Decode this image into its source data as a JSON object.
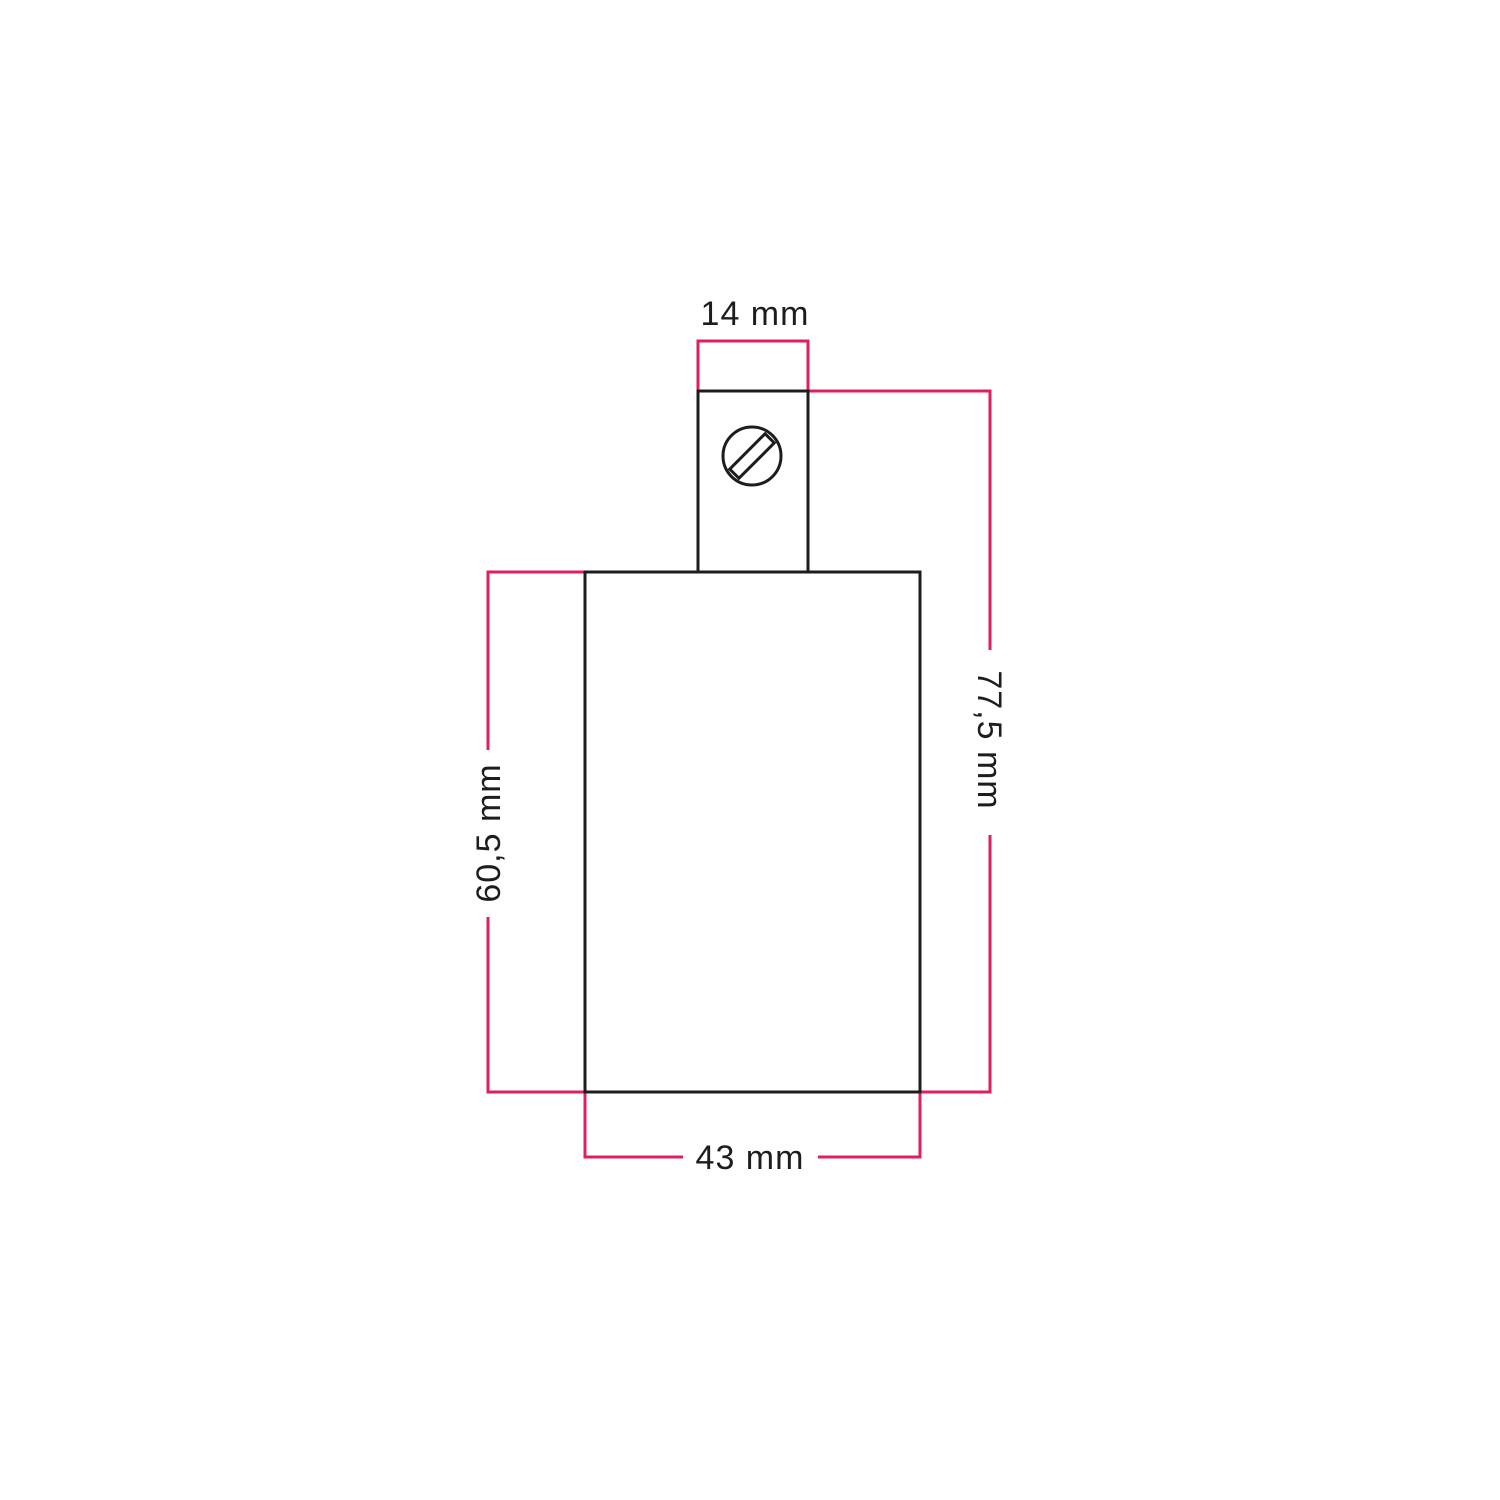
{
  "diagram": {
    "kind": "technical-dimension-drawing",
    "labels": {
      "top_width": "14 mm",
      "right_total_height": "77,5 mm",
      "left_body_height": "60,5 mm",
      "bottom_body_width": "43 mm"
    },
    "icons": {
      "screw_head": "slotted-screw-head-icon"
    },
    "colors": {
      "dimension_lines": "#e01e64",
      "outlines": "#1d1d1b",
      "label_text": "#1d1d1b",
      "background": "#ffffff"
    }
  }
}
